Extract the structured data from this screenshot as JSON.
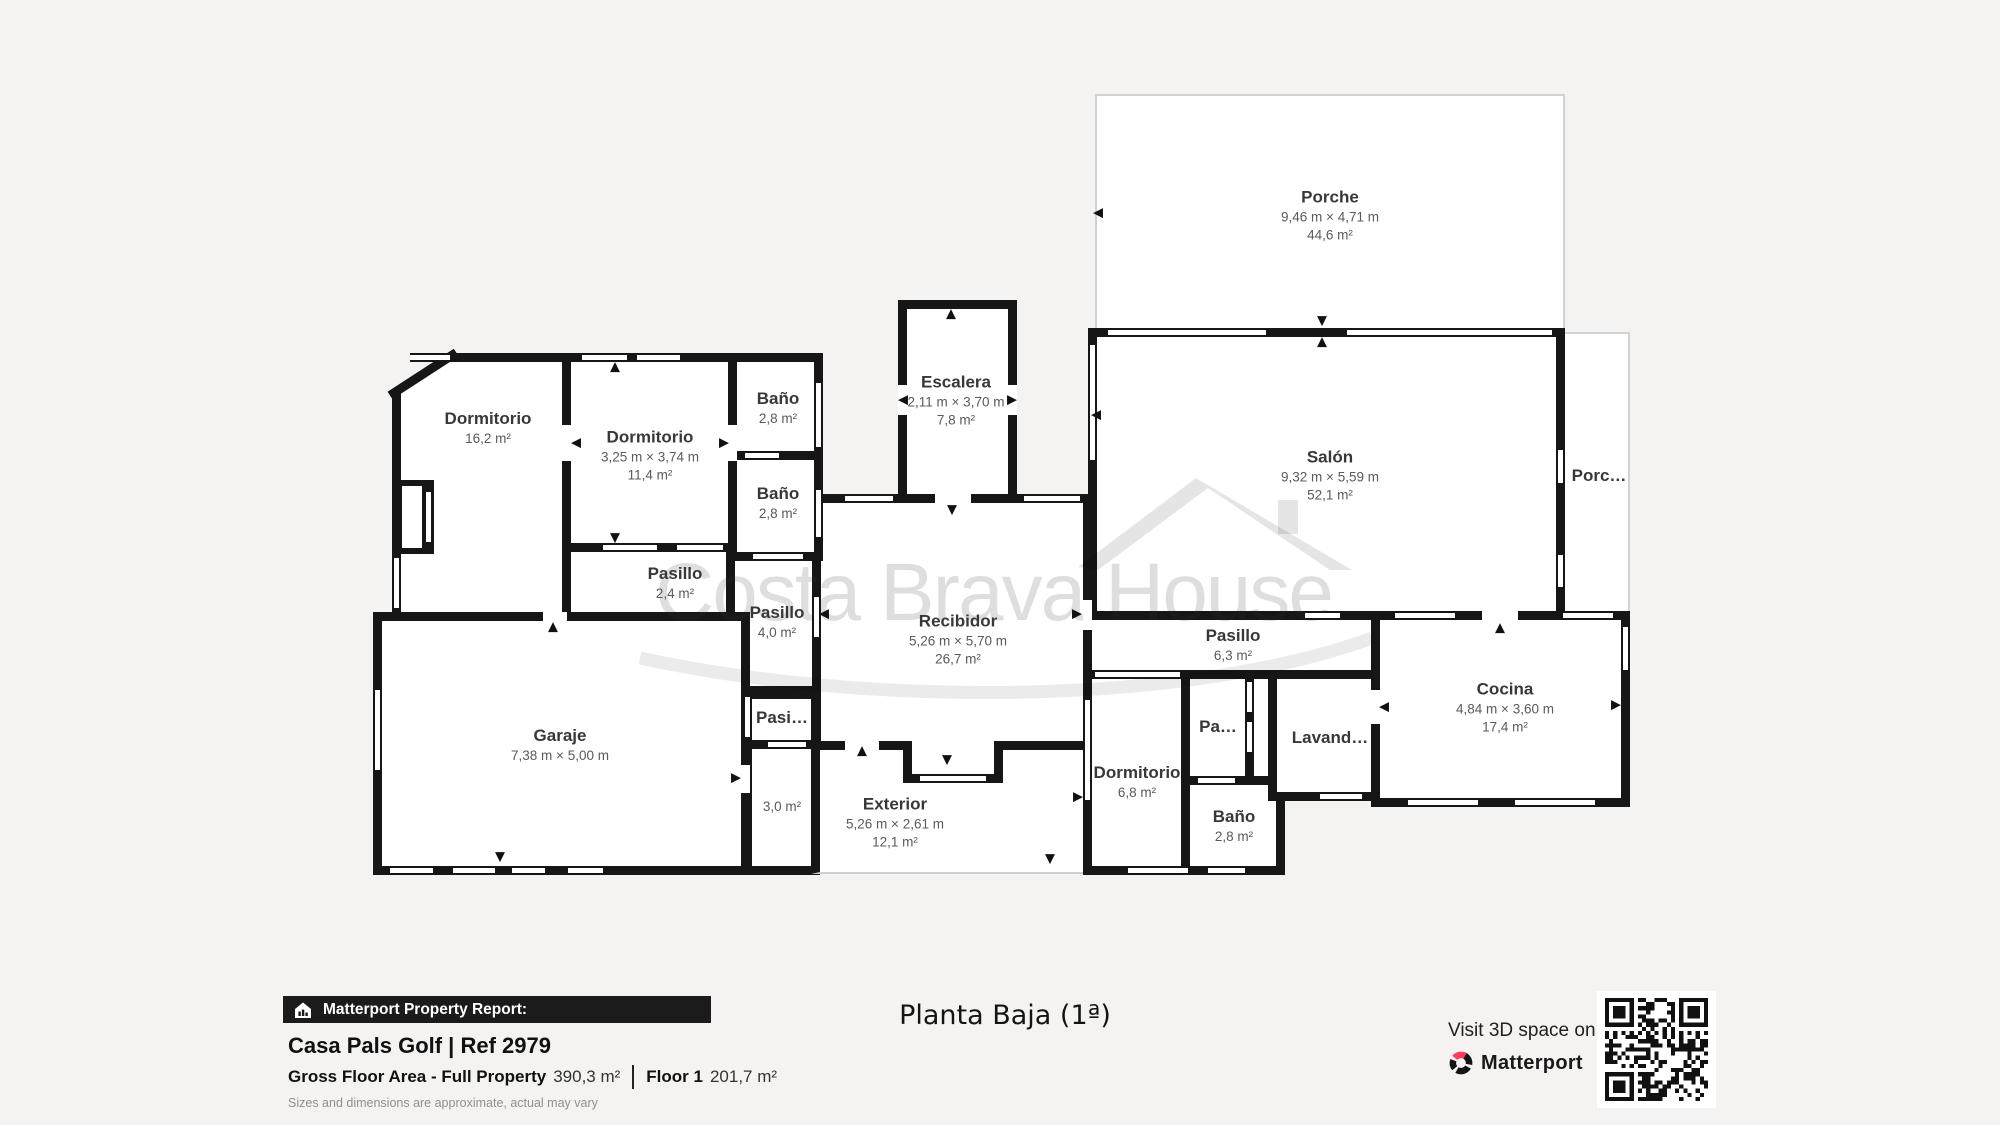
{
  "colors": {
    "background": "#f4f3f1",
    "wall": "#161616",
    "brand_pink": "#ff3e5f",
    "watermark_gray": "#d9d9d9"
  },
  "watermark": {
    "text": "Costa Brava House"
  },
  "icons": {
    "up": "▲",
    "down": "▼",
    "left": "◀",
    "right": "▶"
  },
  "plan": {
    "rooms": [
      {
        "id": "porche",
        "name": "Porche",
        "dims": "9,46 m × 4,71 m",
        "area": "44,6 m²"
      },
      {
        "id": "escalera",
        "name": "Escalera",
        "dims": "2,11 m × 3,70 m",
        "area": "7,8 m²"
      },
      {
        "id": "salon",
        "name": "Salón",
        "dims": "9,32 m × 5,59 m",
        "area": "52,1 m²"
      },
      {
        "id": "porche-lateral",
        "name": "Porc…"
      },
      {
        "id": "dormitorio-1",
        "name": "Dormitorio",
        "area": "16,2 m²"
      },
      {
        "id": "dormitorio-2",
        "name": "Dormitorio",
        "dims": "3,25 m × 3,74 m",
        "area": "11,4 m²"
      },
      {
        "id": "bano-1",
        "name": "Baño",
        "area": "2,8 m²"
      },
      {
        "id": "bano-2",
        "name": "Baño",
        "area": "2,8 m²"
      },
      {
        "id": "pasillo-1",
        "name": "Pasillo",
        "area": "2,4 m²"
      },
      {
        "id": "pasillo-2",
        "name": "Pasillo",
        "area": "4,0 m²"
      },
      {
        "id": "recibidor",
        "name": "Recibidor",
        "dims": "5,26 m × 5,70 m",
        "area": "26,7 m²"
      },
      {
        "id": "garaje",
        "name": "Garaje",
        "dims": "7,38 m × 5,00 m"
      },
      {
        "id": "pasillo-3",
        "name": "Pasi…"
      },
      {
        "id": "pasillo-3b",
        "area": "3,0 m²"
      },
      {
        "id": "exterior",
        "name": "Exterior",
        "dims": "5,26 m × 2,61 m",
        "area": "12,1 m²"
      },
      {
        "id": "pasillo-4",
        "name": "Pasillo",
        "area": "6,3 m²"
      },
      {
        "id": "dormitorio-3",
        "name": "Dormitorio",
        "area": "6,8 m²"
      },
      {
        "id": "pasillo-5",
        "name": "Pa…"
      },
      {
        "id": "bano-3",
        "name": "Baño",
        "area": "2,8 m²"
      },
      {
        "id": "lavanderia",
        "name": "Lavand…"
      },
      {
        "id": "cocina",
        "name": "Cocina",
        "dims": "4,84 m × 3,60 m",
        "area": "17,4 m²"
      }
    ]
  },
  "footer": {
    "report_badge": "Matterport Property Report:",
    "property_title": "Casa Pals Golf | Ref 2979",
    "gross_label": "Gross Floor Area - Full Property",
    "gross_value": "390,3 m²",
    "floor_label": "Floor 1",
    "floor_value": "201,7 m²",
    "disclaimer": "Sizes and dimensions are approximate, actual may vary",
    "floor_title": "Planta Baja (1ª)",
    "visit_text": "Visit 3D space on",
    "brand": "Matterport"
  }
}
